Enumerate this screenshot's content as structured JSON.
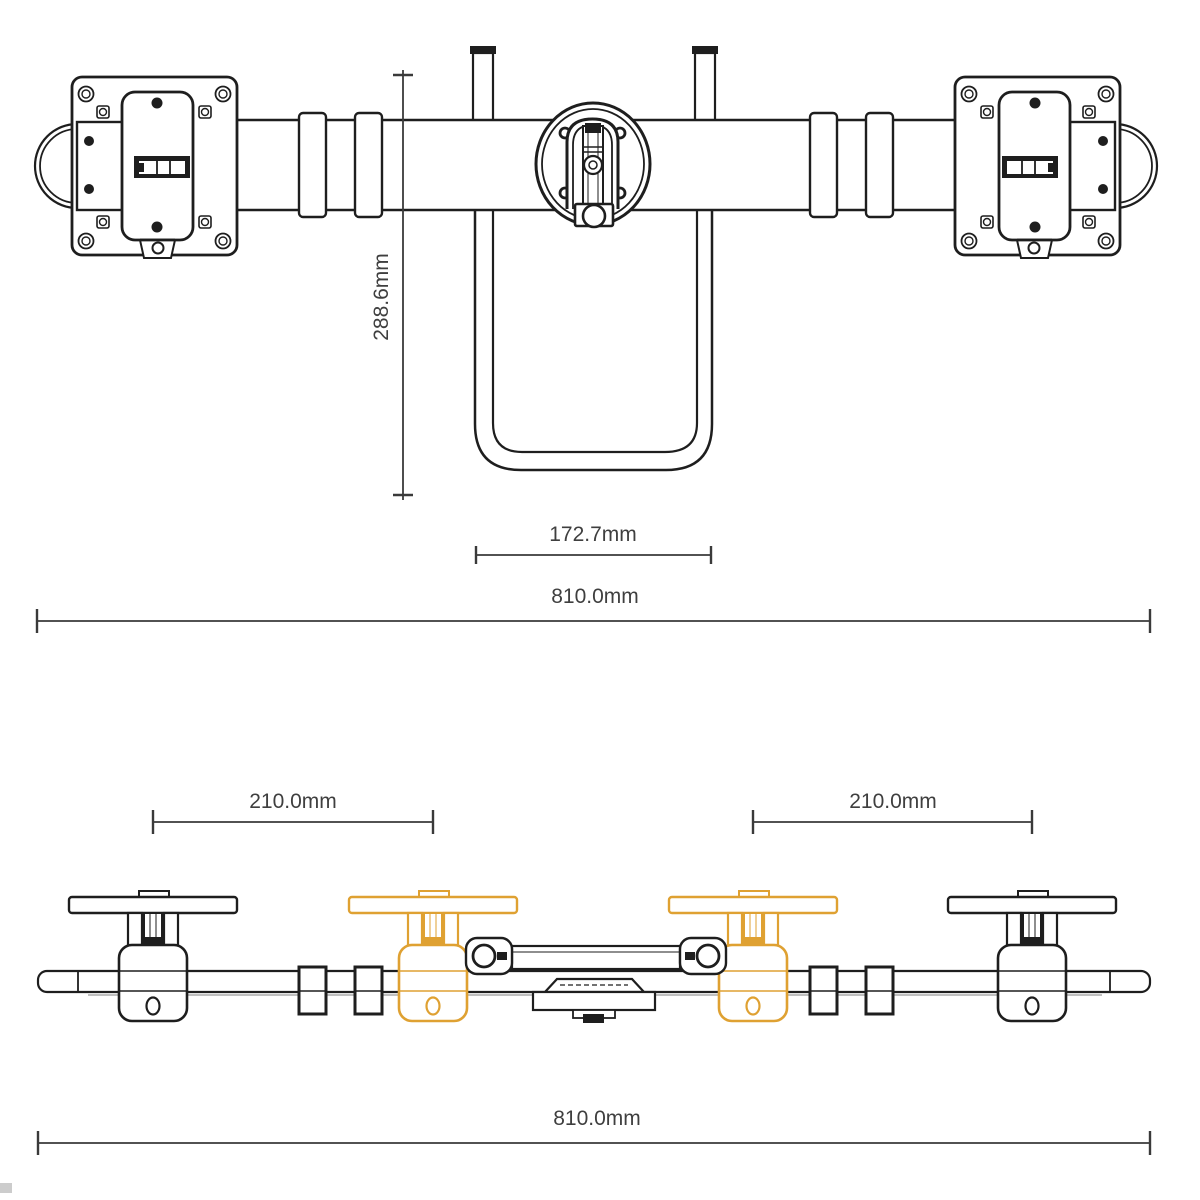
{
  "front_view": {
    "height_dim": "288.6mm",
    "center_offset_dim": "172.7mm",
    "total_width_dim": "810.0mm"
  },
  "top_view": {
    "left_arm_dim": "210.0mm",
    "right_arm_dim": "210.0mm",
    "total_width_dim": "810.0mm"
  },
  "colors": {
    "line": "#1e1e1e",
    "dimension_line": "#3a3a3a",
    "label_text": "#3f3f3f",
    "ghost_position": "#dfa132"
  }
}
